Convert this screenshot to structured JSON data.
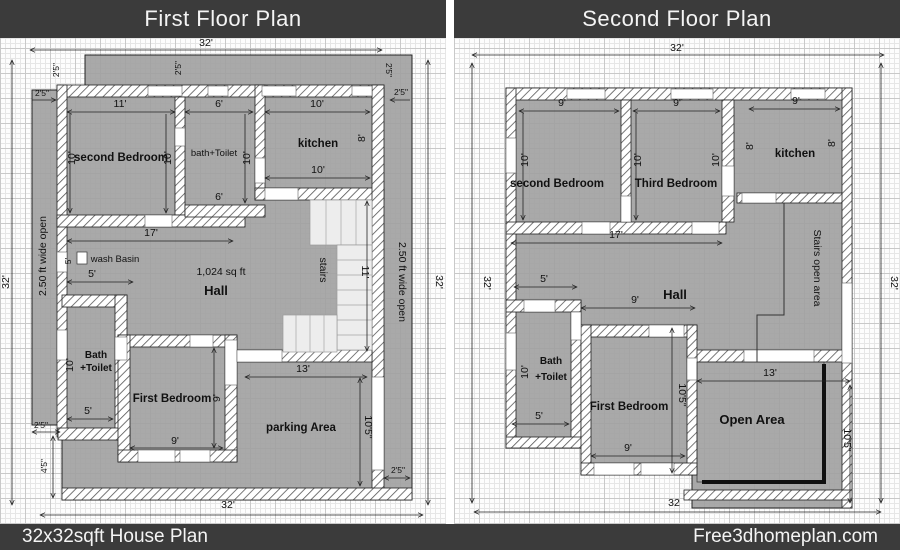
{
  "titles": {
    "first": "First Floor Plan",
    "second": "Second Floor Plan"
  },
  "footer": {
    "left": "32x32sqft House Plan",
    "right": "Free3dhomeplan.com"
  },
  "dims": {
    "ft32": "32'",
    "ft32_plain": "32",
    "ft17": "17'",
    "ft13": "13'",
    "ft11": "11'",
    "ft10": "10'",
    "ft10_5": "10'5\"",
    "ft9": "9'",
    "ft8": "8'",
    "ft6": "6'",
    "ft5": "5'",
    "ft4_5": "4'5\"",
    "ft2_5": "2'5\""
  },
  "ff": {
    "second_bedroom": "second Bedroom",
    "bath_toilet": "bath+Toilet",
    "kitchen": "kitchen",
    "wash_basin": "wash Basin",
    "hall_area": "1,024 sq ft",
    "hall": "Hall",
    "stairs": "stairs",
    "open_left": "2.50 ft wide open",
    "open_right": "2.50 ft wide open",
    "bath": "Bath",
    "toilet": "+Toilet",
    "first_bedroom": "First Bedroom",
    "parking": "parking Area"
  },
  "sf": {
    "second_bedroom": "second Bedroom",
    "third_bedroom": "Third Bedroom",
    "kitchen": "kitchen",
    "stairs_open": "Stairs open area",
    "hall": "Hall",
    "bath": "Bath",
    "toilet": "+Toilet",
    "first_bedroom": "First Bedroom",
    "open_area": "Open Area"
  },
  "colors": {
    "bar": "#3b3b3b",
    "floor": "#a0a0a0",
    "wall_hatch": "#555555"
  }
}
